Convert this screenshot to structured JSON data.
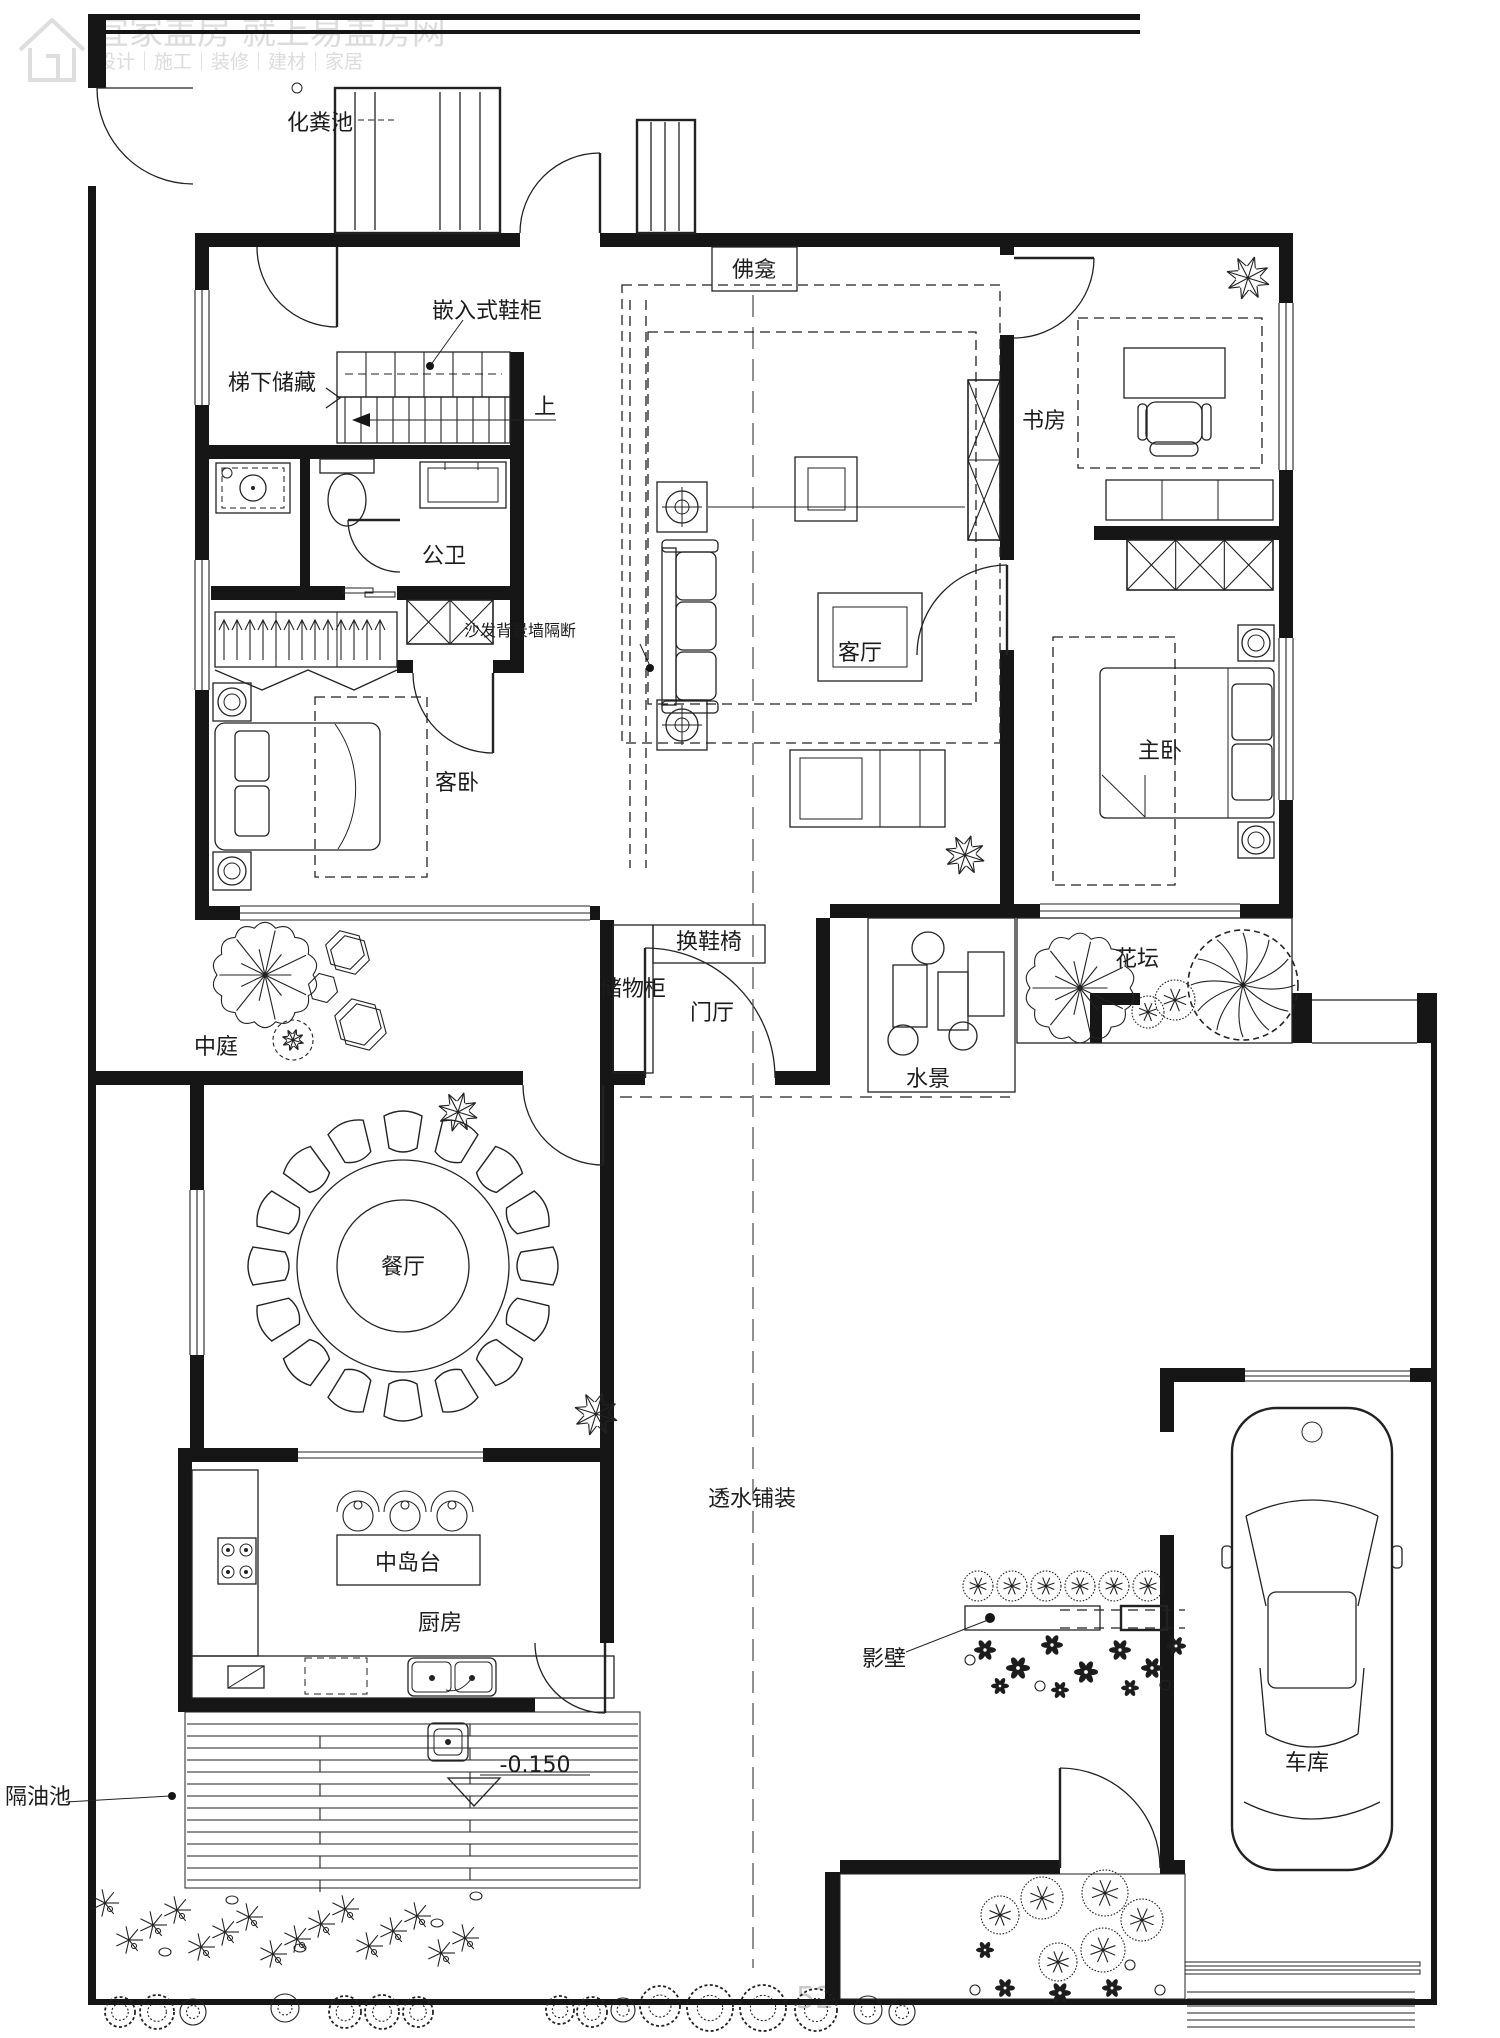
{
  "watermark": {
    "line1": "宜家盖房 就上易盖房网",
    "line2": "设计｜施工｜装修｜建材｜家居",
    "partial_number": "52"
  },
  "labels": {
    "septic_tank": "化粪池",
    "shrine": "佛龛",
    "shoe_cabinet": "嵌入式鞋柜",
    "understair_storage": "梯下储藏",
    "up": "上",
    "study": "书房",
    "public_bath": "公卫",
    "sofa_partition": "沙发背景墙隔断",
    "living_room": "客厅",
    "master_bedroom": "主卧",
    "guest_bedroom": "客卧",
    "shoe_bench": "换鞋椅",
    "storage_cabinet": "储物柜",
    "foyer": "门厅",
    "atrium": "中庭",
    "water_feature": "水景",
    "flower_bed": "花坛",
    "dining_room": "餐厅",
    "kitchen_island": "中岛台",
    "kitchen": "厨房",
    "permeable_paving": "透水铺装",
    "screen_wall": "影壁",
    "elevation": "-0.150",
    "grease_trap": "隔油池",
    "garage": "车库"
  }
}
